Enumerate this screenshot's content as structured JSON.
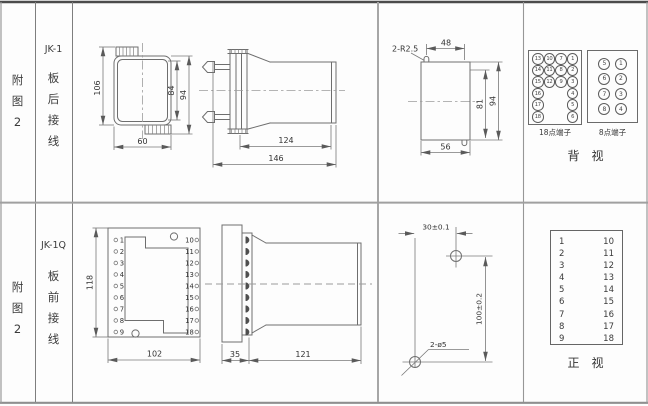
{
  "top_row": {
    "figure": [
      "附",
      "图",
      "2"
    ],
    "model": "JK-1",
    "wiring": [
      "板",
      "后",
      "接",
      "线"
    ],
    "front_view": {
      "h_total": "106",
      "h_inner": "84",
      "h_outer": "94",
      "width": "60"
    },
    "side_view": {
      "body_len": "124",
      "total_len": "146"
    },
    "cutout_view": {
      "note": "2-R2.5",
      "top_width": "48",
      "inner_h": "81",
      "outer_h": "94",
      "bottom_width": "56"
    },
    "terminals18": {
      "caption": "18点端子",
      "cells": [
        "13",
        "10",
        "7",
        "1",
        "14",
        "11",
        "8",
        "2",
        "15",
        "12",
        "9",
        "3",
        "16",
        "4",
        "17",
        "5",
        "18",
        "6"
      ]
    },
    "terminals8": {
      "caption": "8点端子",
      "cells": [
        "5",
        "1",
        "6",
        "2",
        "7",
        "3",
        "8",
        "4"
      ]
    },
    "view_caption": "背　视"
  },
  "bottom_row": {
    "figure": [
      "附",
      "图",
      "2"
    ],
    "model": "JK-1Q",
    "wiring": [
      "板",
      "前",
      "接",
      "线"
    ],
    "front_view": {
      "height": "118",
      "width": "102",
      "left": [
        "1",
        "2",
        "3",
        "4",
        "5",
        "6",
        "7",
        "8",
        "9"
      ],
      "right": [
        "10",
        "11",
        "12",
        "13",
        "14",
        "15",
        "16",
        "17",
        "18"
      ]
    },
    "side_view": {
      "flange": "35",
      "body_len": "121"
    },
    "drill_view": {
      "h_pitch": "30±0.1",
      "v_pitch": "100±0.2",
      "note": "2-ø5"
    },
    "terminal_table": {
      "left": [
        "1",
        "2",
        "3",
        "4",
        "5",
        "6",
        "7",
        "8",
        "9"
      ],
      "right": [
        "10",
        "11",
        "12",
        "13",
        "14",
        "15",
        "16",
        "17",
        "18"
      ]
    },
    "view_caption": "正　视"
  }
}
